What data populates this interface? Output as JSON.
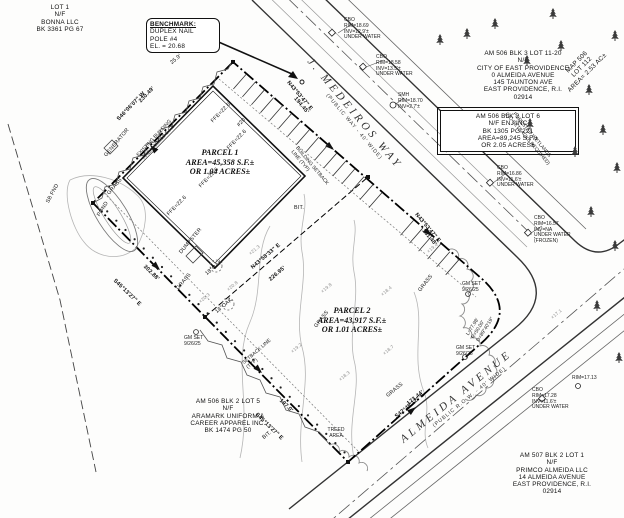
{
  "drawing": {
    "kind": "property survey site plan",
    "ink_color": "#1a1a1a",
    "contour_color": "#b5b5b5",
    "paper_color": "#fdfdfc"
  },
  "blocks": [
    {
      "name": "lot1-abutter",
      "x": 8,
      "y": 4,
      "w": 104,
      "cls": "tb ctr",
      "lines": [
        "LOT 1",
        "N/F",
        "BONNA LLC",
        "BK 3361 PG 67"
      ]
    },
    {
      "name": "benchmark-note",
      "x": 146,
      "y": 18,
      "w": 66,
      "cls": "tb boxed bm",
      "lines": [
        "BENCHMARK:",
        "DUPLEX NAIL",
        "POLE #4",
        "EL. = 20.68"
      ]
    },
    {
      "name": "city-abutter",
      "x": 438,
      "y": 50,
      "w": 170,
      "cls": "tb ctr",
      "lines": [
        "AM 506 BLK 3 LOT 11-20",
        "N/F",
        "CITY OF EAST PROVIDENCE",
        "0 ALMEIDA AVENUE",
        "145 TAUNTON AVE",
        "EAST PROVIDENCE, R.I.",
        "02914"
      ]
    },
    {
      "name": "enj-parcel-note",
      "x": 440,
      "y": 110,
      "w": 128,
      "cls": "tb boxed dbl ctr",
      "lines": [
        "AM 506 BLK 2 LOT 6",
        "N/F ENJ INC",
        "BK 1305 PG 221",
        "AREA=89,245 S.F.±",
        "OR 2.05 ACRES±"
      ]
    },
    {
      "name": "map-506-lot",
      "x": 546,
      "y": 88,
      "w": 80,
      "rot": -45,
      "cls": "tb ctr",
      "lines": [
        "MAP 506",
        "LOT 112",
        "AREA= 2.53 AC±"
      ]
    },
    {
      "name": "forested-wetlands-note",
      "x": 505,
      "y": 100,
      "w": 88,
      "rot": 50,
      "cls": "t5 ctr",
      "lines": [
        "FORESTED WETLANDS",
        "(NO SETBACKS REQUIRED)"
      ]
    },
    {
      "name": "street-medeiros",
      "x": 314,
      "y": 56,
      "w": 160,
      "rot": 50,
      "cls": "street",
      "lines": [
        "J. MEDEIROS WAY",
        "(PUBLIC WAY - 40' WIDE)"
      ]
    },
    {
      "name": "street-almeida",
      "x": 398,
      "y": 436,
      "w": 160,
      "rot": -39,
      "cls": "street",
      "lines": [
        "ALMEIDA AVENUE",
        "(PUBLIC R.O.W. - 40' WIDE)"
      ]
    },
    {
      "name": "parcel1-label",
      "x": 150,
      "y": 148,
      "w": 140,
      "cls": "parcel ctr",
      "lines": [
        "PARCEL 1",
        "AREA=45,358 S.F.±",
        "OR 1.04 ACRES±"
      ]
    },
    {
      "name": "parcel2-label",
      "x": 282,
      "y": 306,
      "w": 140,
      "cls": "parcel ctr",
      "lines": [
        "PARCEL 2",
        "AREA=43,917 S.F.±",
        "OR 1.01 ACRES±"
      ]
    },
    {
      "name": "aramark-abutter",
      "x": 136,
      "y": 398,
      "w": 184,
      "cls": "tb ctr",
      "lines": [
        "AM 506 BLK 2 LOT 5",
        "N/F",
        "ARAMARK UNIFORM &",
        "CAREER APPAREL INC.",
        "BK 1474 PG 50"
      ]
    },
    {
      "name": "primco-abutter",
      "x": 486,
      "y": 452,
      "w": 132,
      "cls": "tb ctr",
      "lines": [
        "AM 507 BLK 2 LOT 1",
        "N/F",
        "PRIMCO ALMEIDA LLC",
        "14 ALMEIDA AVENUE",
        "EAST PROVIDENCE, R.I.",
        "02914"
      ]
    },
    {
      "name": "existing-building-label",
      "x": 120,
      "y": 172,
      "w": 96,
      "rot": -47,
      "cls": "t5 ctr",
      "lines": [
        "EXISTING BUILDING",
        "AREA=10,013 S.F.±"
      ]
    },
    {
      "name": "curve-data",
      "x": 466,
      "y": 334,
      "rot": -58,
      "cls": "t5",
      "lines": [
        "L=77.98'",
        "R=50.00'",
        "D=89°40'19\""
      ]
    },
    {
      "name": "note-cb-1",
      "x": 344,
      "y": 18,
      "cls": "t5",
      "lines": [
        "CBO",
        "RIM=18.69",
        "INV=12.9'±",
        "UNDER WATER"
      ]
    },
    {
      "name": "note-cb-2",
      "x": 376,
      "y": 55,
      "cls": "t5",
      "lines": [
        "CBO",
        "RIM=18.58",
        "INV=13.5'±",
        "UNDER WATER"
      ]
    },
    {
      "name": "note-smh-1",
      "x": 398,
      "y": 93,
      "cls": "t5",
      "lines": [
        "SMH",
        "RIM=18.70",
        "INV=2.7'±"
      ]
    },
    {
      "name": "note-cb-3",
      "x": 497,
      "y": 166,
      "cls": "t5",
      "lines": [
        "CBO",
        "RIM=16.86",
        "INV=11.6'±",
        "UNDER WATER"
      ]
    },
    {
      "name": "note-cb-4",
      "x": 534,
      "y": 216,
      "cls": "t5",
      "lines": [
        "CBO",
        "RIM=16.57",
        "INV=NA",
        "UNDER WATER",
        "(FROZEN)"
      ]
    },
    {
      "name": "note-rim-1",
      "x": 572,
      "y": 376,
      "cls": "t5",
      "lines": [
        "RIM=17.13"
      ]
    },
    {
      "name": "note-cb-5",
      "x": 532,
      "y": 388,
      "cls": "t5",
      "lines": [
        "CBO",
        "RIM=17.28",
        "INV=11.6'±",
        "UNDER WATER"
      ]
    },
    {
      "name": "gm-set-1",
      "x": 184,
      "y": 336,
      "cls": "t5",
      "lines": [
        "GM SET",
        "9/26/25"
      ]
    },
    {
      "name": "gm-set-2",
      "x": 462,
      "y": 282,
      "cls": "t5",
      "lines": [
        "GM SET",
        "9/26/25"
      ]
    },
    {
      "name": "gm-set-3",
      "x": 456,
      "y": 346,
      "cls": "t5",
      "lines": [
        "GM SET",
        "9/26/25"
      ]
    },
    {
      "name": "treed-area-label",
      "x": 316,
      "y": 428,
      "w": 40,
      "cls": "t5 ctr",
      "lines": [
        "TREED",
        "AREA"
      ]
    },
    {
      "name": "setback-side-label",
      "x": 242,
      "y": 362,
      "rot": -41,
      "cls": "t5",
      "lines": [
        "SETBACK LINE",
        "(TYP)"
      ]
    },
    {
      "name": "setback-front-label",
      "x": 298,
      "y": 146,
      "rot": 50,
      "cls": "t5",
      "lines": [
        "BUILDING SETBACK",
        "LINE (TYP)"
      ]
    }
  ],
  "annotations": [
    {
      "name": "dim-nw-dist",
      "t": "230.49'",
      "x": 138,
      "y": 100,
      "r": -46,
      "cls": "dim"
    },
    {
      "name": "dim-nw-bearing",
      "t": "S46°06'07\" W",
      "x": 116,
      "y": 118,
      "r": -46,
      "cls": "dim"
    },
    {
      "name": "dim-w1-dist",
      "t": "302.88'",
      "x": 146,
      "y": 264,
      "r": 44,
      "cls": "dim"
    },
    {
      "name": "dim-w1-bearing",
      "t": "S45°13'27\" E",
      "x": 116,
      "y": 278,
      "r": 44,
      "cls": "dim"
    },
    {
      "name": "dim-w2-dist",
      "t": "197.0'",
      "x": 282,
      "y": 398,
      "r": 44,
      "cls": "dim"
    },
    {
      "name": "dim-w2-bearing",
      "t": "S45°13'27\" E",
      "x": 258,
      "y": 412,
      "r": 44,
      "cls": "dim"
    },
    {
      "name": "dim-almeida-dist",
      "t": "173.44'",
      "x": 406,
      "y": 402,
      "r": -39,
      "cls": "dim"
    },
    {
      "name": "dim-almeida-bearing",
      "t": "S42°48'12\" E",
      "x": 394,
      "y": 415,
      "r": -39,
      "cls": "dim"
    },
    {
      "name": "dim-medeiros1-bearing",
      "t": "N43°53'47\" E",
      "x": 290,
      "y": 80,
      "r": 50,
      "cls": "dim"
    },
    {
      "name": "dim-medeiros1-dist",
      "t": "194.45'",
      "x": 297,
      "y": 96,
      "r": 50,
      "cls": "dim"
    },
    {
      "name": "dim-medeiros2-bearing",
      "t": "N43°53'47\" E",
      "x": 418,
      "y": 212,
      "r": 50,
      "cls": "dim"
    },
    {
      "name": "dim-medeiros2-dist",
      "t": "151.48'",
      "x": 425,
      "y": 228,
      "r": 50,
      "cls": "dim"
    },
    {
      "name": "dim-division-bearing",
      "t": "N43°58'33\" E",
      "x": 250,
      "y": 266,
      "r": -40,
      "cls": "dim"
    },
    {
      "name": "dim-division-dist",
      "t": "226.95'",
      "x": 268,
      "y": 278,
      "r": -40,
      "cls": "dim"
    },
    {
      "name": "bldg-number",
      "t": "#20",
      "x": 236,
      "y": 124,
      "r": -46,
      "cls": ""
    },
    {
      "name": "ffe-1",
      "t": "FFE=22.6",
      "x": 210,
      "y": 120,
      "r": -46,
      "cls": ""
    },
    {
      "name": "ffe-2",
      "t": "FFE=22.6",
      "x": 226,
      "y": 147,
      "r": -46,
      "cls": ""
    },
    {
      "name": "ffe-3",
      "t": "FFE=22.6",
      "x": 198,
      "y": 185,
      "r": -46,
      "cls": ""
    },
    {
      "name": "ffe-4",
      "t": "FFE=22.6",
      "x": 166,
      "y": 213,
      "r": -46,
      "cls": ""
    },
    {
      "name": "generator-label",
      "t": "GENERATOR",
      "x": 104,
      "y": 155,
      "r": -50,
      "cls": "t5"
    },
    {
      "name": "pond-label",
      "t": "POND",
      "x": 97,
      "y": 215,
      "r": -58,
      "cls": "t5"
    },
    {
      "name": "grass-1",
      "t": "GRASS",
      "x": 107,
      "y": 193,
      "r": -50,
      "cls": "t5"
    },
    {
      "name": "grass-2",
      "t": "GRASS",
      "x": 176,
      "y": 288,
      "r": -50,
      "cls": "t5"
    },
    {
      "name": "grass-3",
      "t": "GRASS",
      "x": 314,
      "y": 326,
      "r": -52,
      "cls": "t5"
    },
    {
      "name": "grass-4",
      "t": "GRASS",
      "x": 418,
      "y": 290,
      "r": -52,
      "cls": "t5"
    },
    {
      "name": "grass-5",
      "t": "GRASS",
      "x": 386,
      "y": 395,
      "r": -40,
      "cls": "t5"
    },
    {
      "name": "dumpster-label",
      "t": "DUMPSTER",
      "x": 179,
      "y": 252,
      "r": -50,
      "cls": "t5"
    },
    {
      "name": "oak-1",
      "t": "18\"OAK",
      "x": 205,
      "y": 273,
      "r": -40,
      "cls": "t5"
    },
    {
      "name": "oak-2",
      "t": "14\"OAK",
      "x": 215,
      "y": 311,
      "r": -40,
      "cls": "t5"
    },
    {
      "name": "bit-1",
      "t": "BIT.",
      "x": 294,
      "y": 206,
      "r": 0,
      "cls": "t5"
    },
    {
      "name": "bit-2",
      "t": "BIT.",
      "x": 262,
      "y": 437,
      "r": -40,
      "cls": "t5"
    },
    {
      "name": "tie-dist",
      "t": "25.9'",
      "x": 170,
      "y": 62,
      "r": -40,
      "cls": "t5"
    },
    {
      "name": "sb-fnd",
      "t": "SB FND",
      "x": 46,
      "y": 202,
      "r": -62,
      "cls": "t5"
    },
    {
      "name": "spot-1",
      "t": "×19.8",
      "x": 320,
      "y": 290,
      "r": -40,
      "cls": "spot"
    },
    {
      "name": "spot-2",
      "t": "×18.4",
      "x": 380,
      "y": 293,
      "r": -40,
      "cls": "spot"
    },
    {
      "name": "spot-3",
      "t": "×19.2",
      "x": 290,
      "y": 350,
      "r": -40,
      "cls": "spot"
    },
    {
      "name": "spot-4",
      "t": "×18.7",
      "x": 382,
      "y": 352,
      "r": -40,
      "cls": "spot"
    },
    {
      "name": "spot-5",
      "t": "×18.3",
      "x": 338,
      "y": 378,
      "r": -40,
      "cls": "spot"
    },
    {
      "name": "spot-6",
      "t": "×20.8",
      "x": 226,
      "y": 288,
      "r": -40,
      "cls": "spot"
    },
    {
      "name": "spot-7",
      "t": "×20.3",
      "x": 198,
      "y": 300,
      "r": -40,
      "cls": "spot"
    },
    {
      "name": "spot-8",
      "t": "×21.3",
      "x": 248,
      "y": 252,
      "r": -40,
      "cls": "spot"
    },
    {
      "name": "spot-9",
      "t": "×17.1",
      "x": 550,
      "y": 316,
      "r": -40,
      "cls": "spot"
    },
    {
      "name": "spot-10",
      "t": "×19.4",
      "x": 426,
      "y": 250,
      "r": -40,
      "cls": "spot"
    }
  ],
  "trees": [
    [
      435,
      34
    ],
    [
      462,
      28
    ],
    [
      490,
      18
    ],
    [
      522,
      55
    ],
    [
      548,
      8
    ],
    [
      556,
      40
    ],
    [
      584,
      84
    ],
    [
      610,
      30
    ],
    [
      598,
      124
    ],
    [
      570,
      146
    ],
    [
      612,
      162
    ],
    [
      586,
      206
    ],
    [
      610,
      240
    ],
    [
      525,
      118
    ],
    [
      592,
      300
    ],
    [
      614,
      352
    ]
  ]
}
